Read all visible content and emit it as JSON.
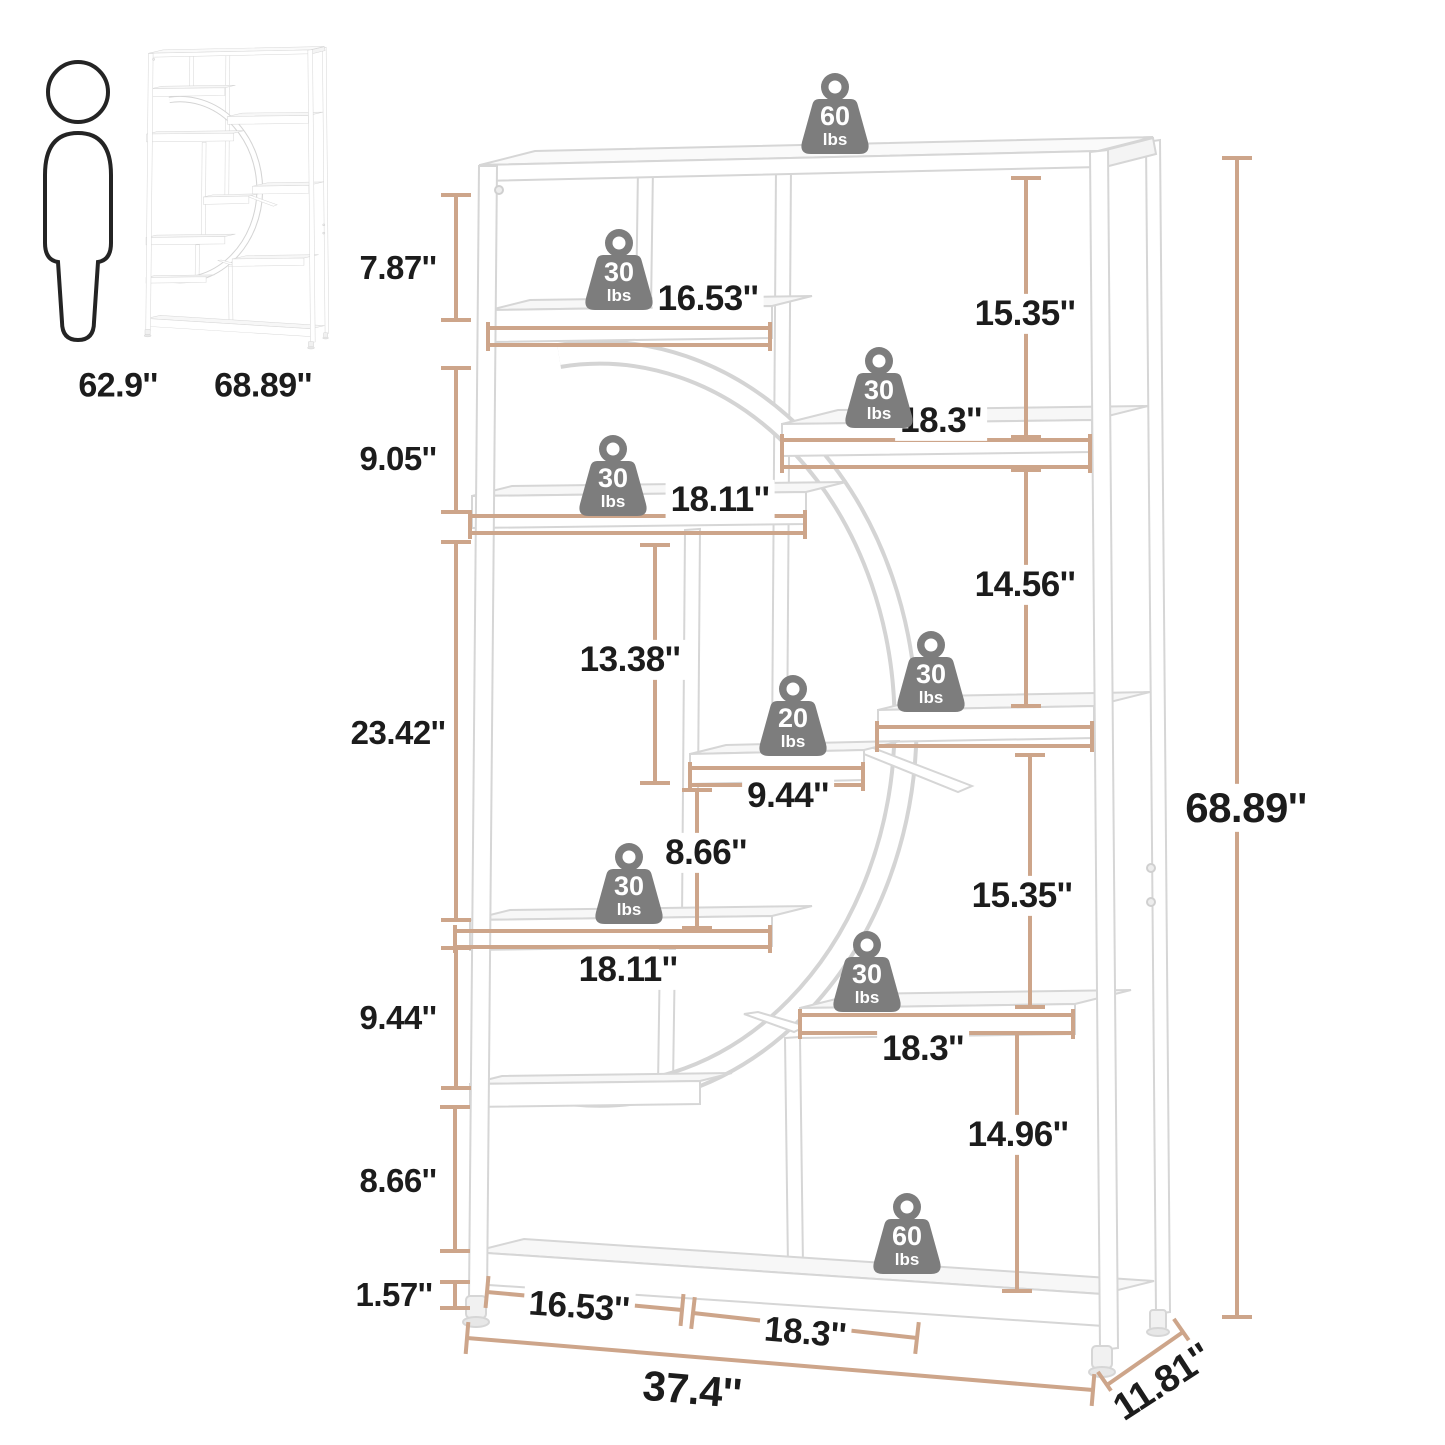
{
  "title": "Bookshelf dimension diagram",
  "colors": {
    "dimension_line": "#cda58a",
    "weight_fill": "#7d7d7d",
    "weight_text": "#ffffff",
    "label_text": "#1c1c1c",
    "furniture_stroke": "#d6d6d6"
  },
  "dims": {
    "person_height": "62.9''",
    "thumb_height": "68.89''",
    "left_7_87": "7.87''",
    "left_9_05": "9.05''",
    "left_23_42": "23.42''",
    "left_9_44": "9.44''",
    "left_8_66": "8.66''",
    "left_1_57": "1.57''",
    "shelf_16_53": "16.53''",
    "shelf_18_3_upper": "18.3''",
    "shelf_18_11_upper": "18.11''",
    "right_15_35_top": "15.35''",
    "right_14_56": "14.56''",
    "mid_13_38": "13.38''",
    "shelf_9_44": "9.44''",
    "mid_8_66": "8.66''",
    "shelf_18_11_lower": "18.11''",
    "right_15_35_bottom": "15.35''",
    "shelf_18_3_lower": "18.3''",
    "right_14_96": "14.96''",
    "total_height": "68.89''",
    "bottom_16_53": "16.53''",
    "bottom_18_3": "18.3''",
    "total_width": "37.4''",
    "total_depth": "11.81''"
  },
  "weights": {
    "top_surface": {
      "value": "60",
      "unit": "lbs"
    },
    "shelf_16_53": {
      "value": "30",
      "unit": "lbs"
    },
    "shelf_18_3_upper": {
      "value": "30",
      "unit": "lbs"
    },
    "shelf_18_11_upper": {
      "value": "30",
      "unit": "lbs"
    },
    "shelf_mid_right": {
      "value": "30",
      "unit": "lbs"
    },
    "shelf_small": {
      "value": "20",
      "unit": "lbs"
    },
    "shelf_18_11_lower": {
      "value": "30",
      "unit": "lbs"
    },
    "shelf_18_3_lower": {
      "value": "30",
      "unit": "lbs"
    },
    "bottom_shelf": {
      "value": "60",
      "unit": "lbs"
    }
  }
}
